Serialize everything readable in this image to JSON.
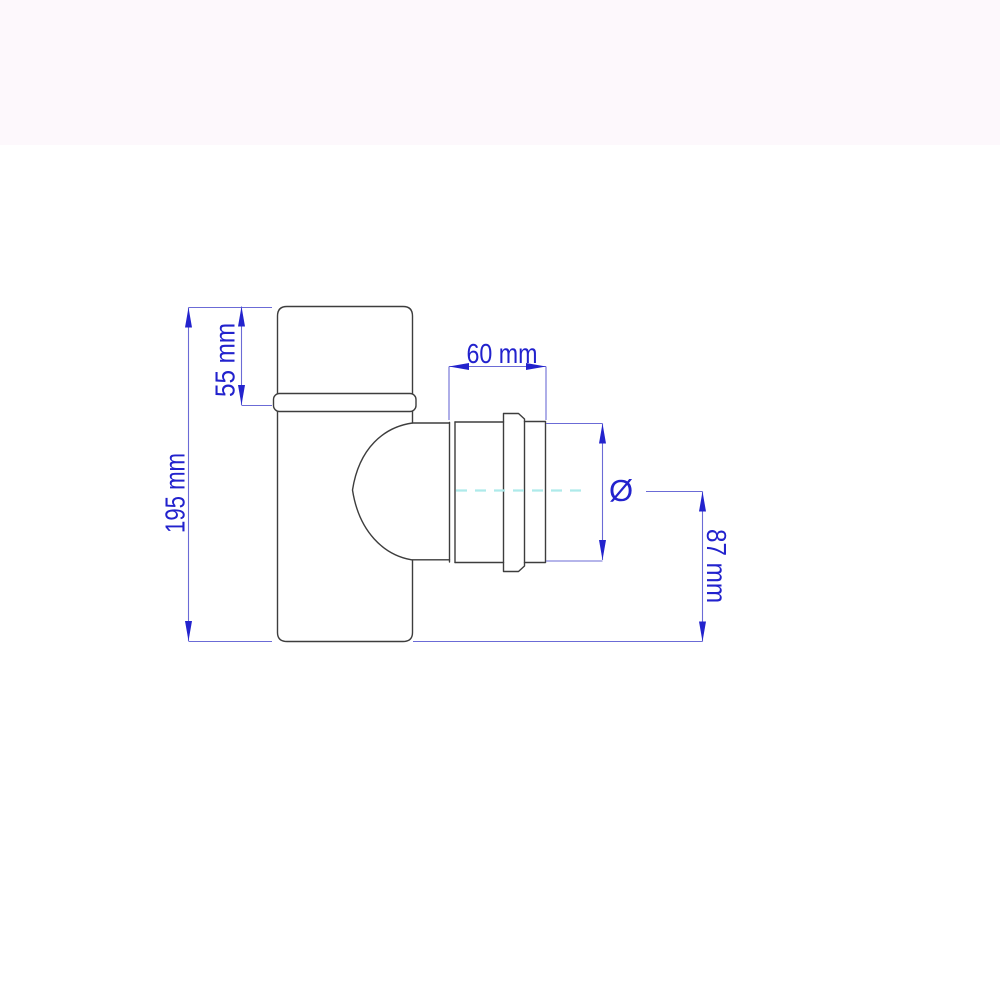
{
  "diagram": {
    "type": "technical-dimension-drawing",
    "dimensions": {
      "height_label": "195 mm",
      "collar_label": "55 mm",
      "spigot_length_label": "60 mm",
      "diameter_symbol": "Ø",
      "offset_label": "87 mm"
    },
    "colors": {
      "outline": "#3d3d3d",
      "dimension_text": "#2222cd",
      "dimension_line": "#6b6bd6",
      "arrow": "#2323cd",
      "centerline": "#aeeaea",
      "background": "#ffffff",
      "top_band": "#fdf8fc"
    }
  }
}
